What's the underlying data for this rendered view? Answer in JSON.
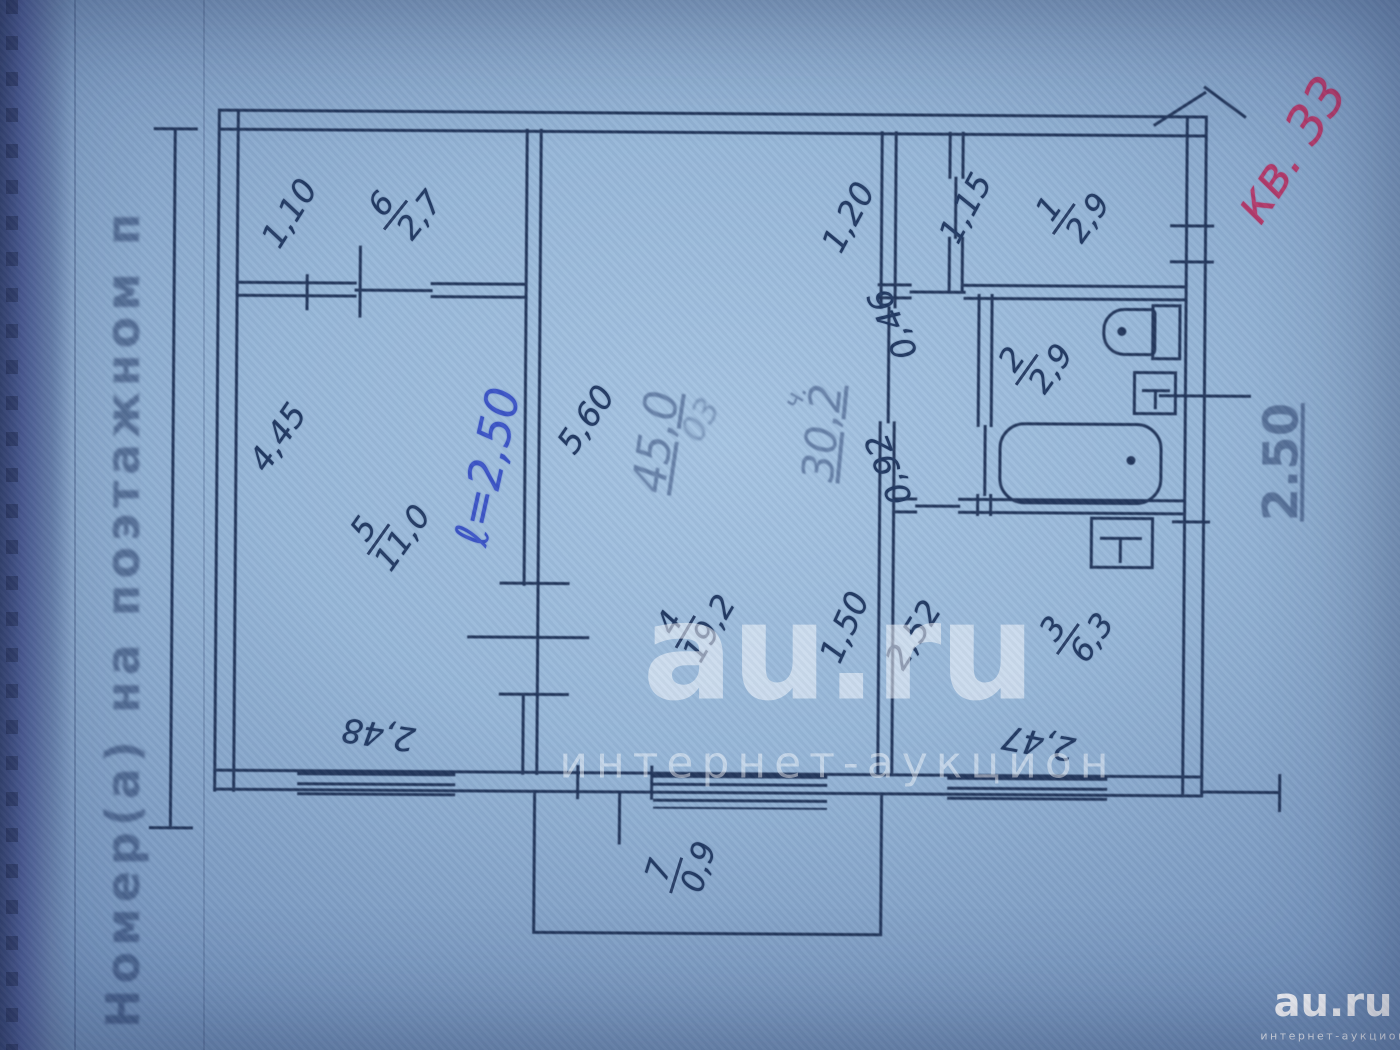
{
  "form": {
    "left_label": "Номер(а) на поэтажном п",
    "right_dim": "2.50"
  },
  "annotations": {
    "red_apartment": "кв. 33",
    "blue_length": "ℓ=2,50"
  },
  "stamps": {
    "s1": "45,0",
    "s2": "03",
    "s3": "ч.",
    "s4": "30,2"
  },
  "rooms": {
    "r6": {
      "num": "6",
      "area": "2,7"
    },
    "r5": {
      "num": "5",
      "area": "11,0"
    },
    "r4": {
      "num": "4",
      "area": "19,2"
    },
    "r1": {
      "num": "1",
      "area": "2,9"
    },
    "r2": {
      "num": "2",
      "area": "2,9"
    },
    "r3": {
      "num": "3",
      "area": "6,3"
    },
    "r7": {
      "num": "7",
      "area": "0,9"
    }
  },
  "dims": {
    "d1_10": "1,10",
    "d1_20": "1,20",
    "d1_15": "1,15",
    "d4_45": "4,45",
    "d5_60": "5,60",
    "d0_46": "0,46",
    "d0_92": "0,92",
    "d1_50": "1,50",
    "d2_52": "2,52",
    "d2_48": "2,48",
    "d2_47": "2,47"
  },
  "watermark": {
    "title": "au.ru",
    "subtitle": "интернет-аукцион"
  },
  "logo": {
    "title": "au.ru",
    "subtitle": "интернет-аукцион"
  }
}
